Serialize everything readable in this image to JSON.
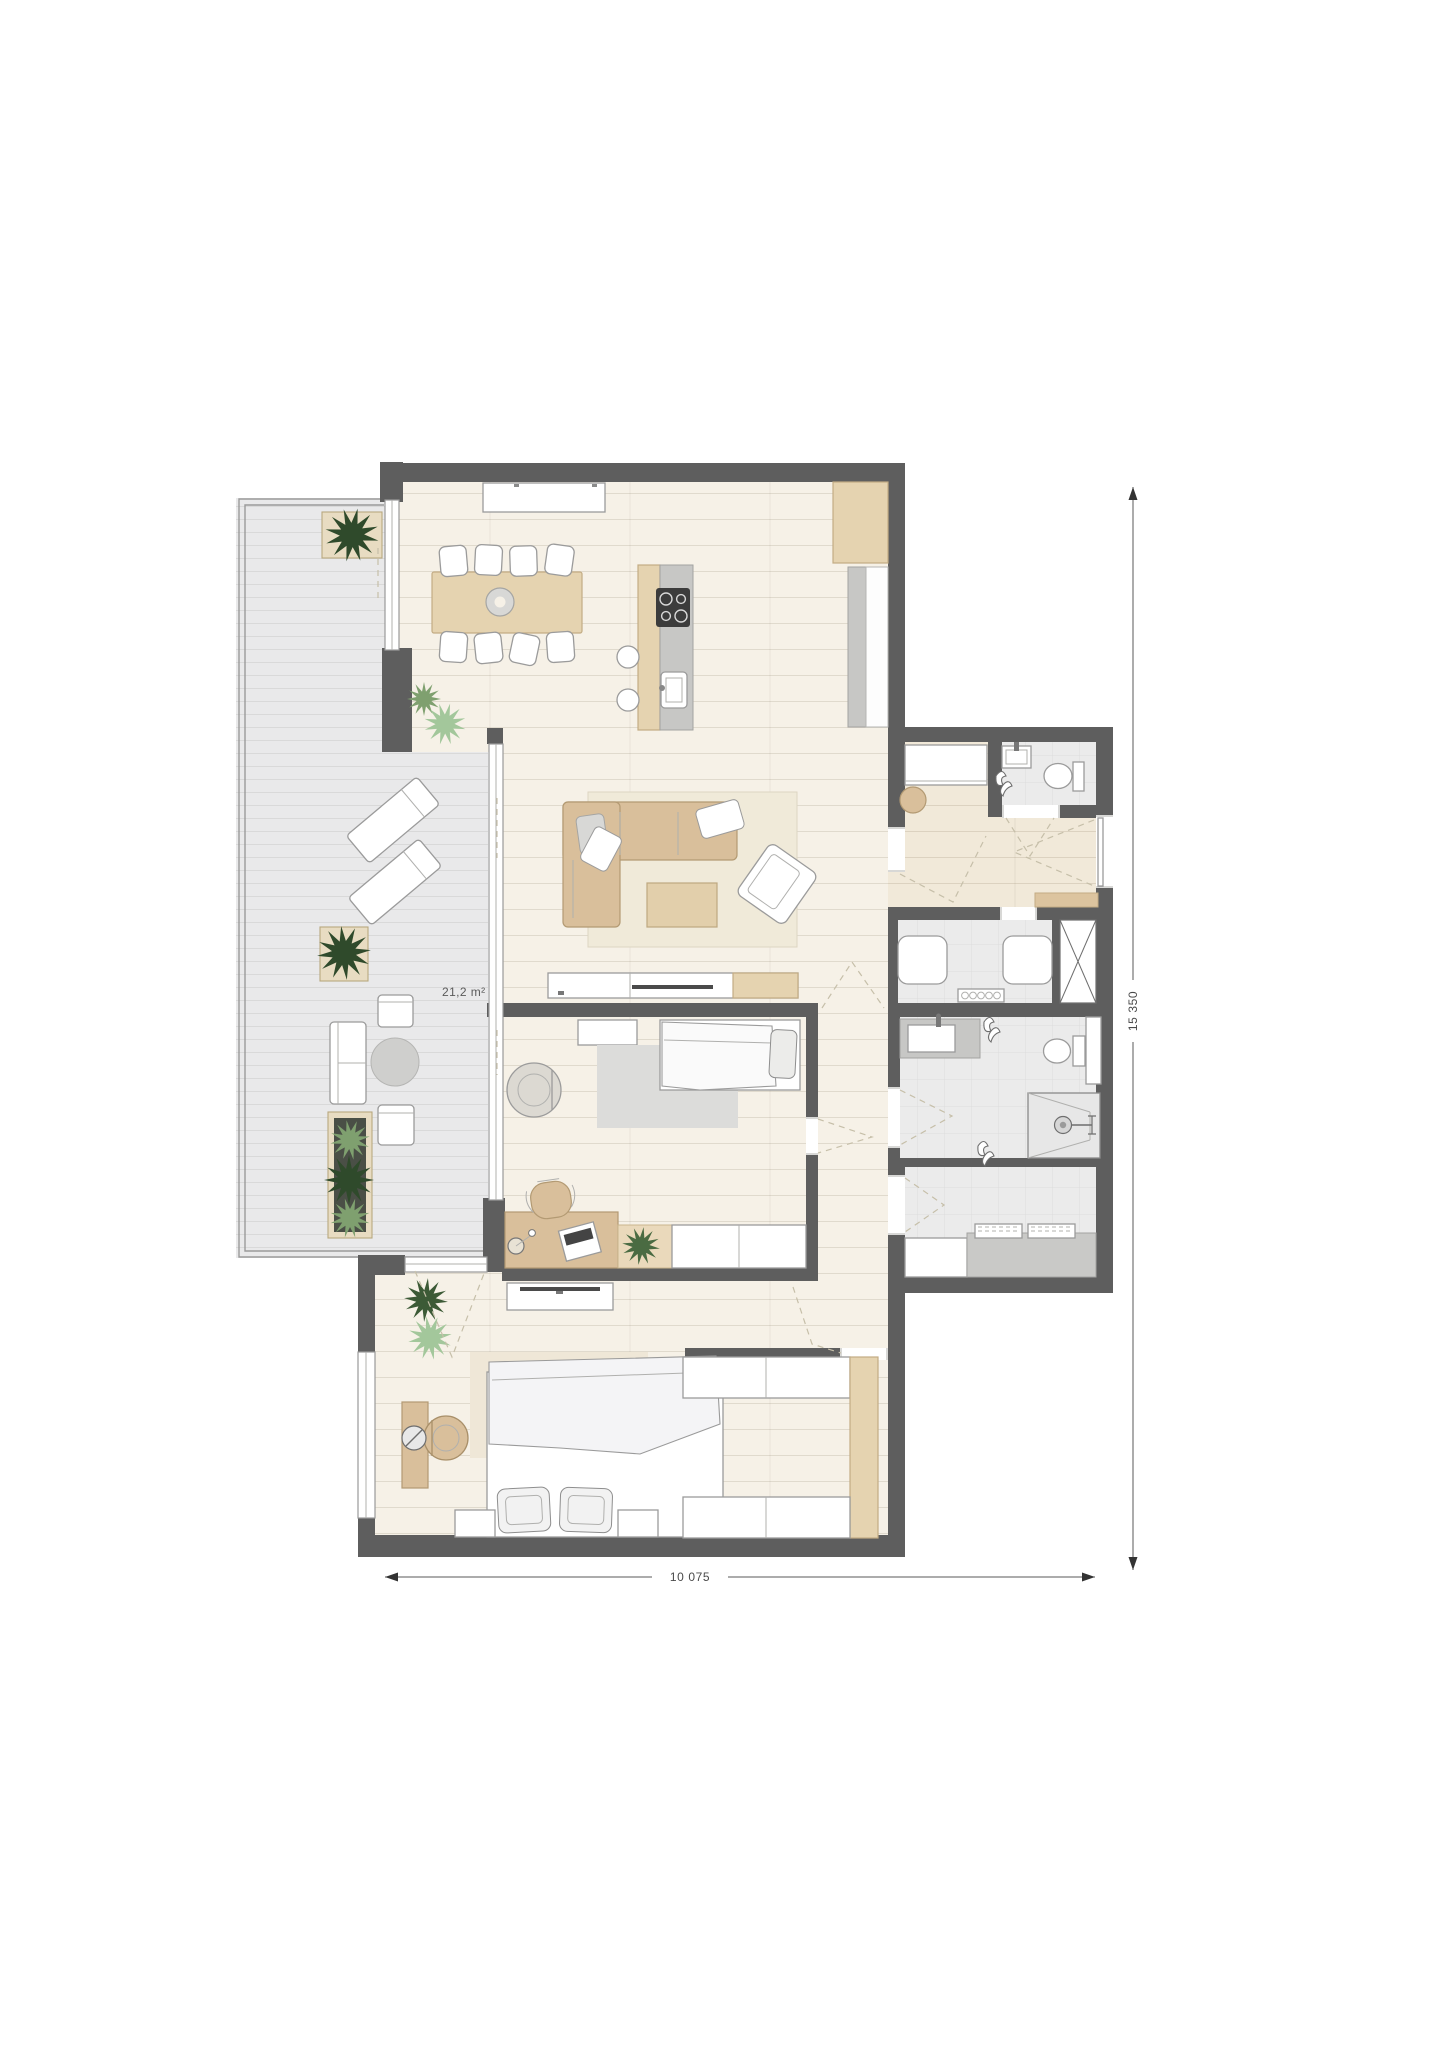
{
  "labels": {
    "balcony_area": "21,2 m²",
    "dim_width": "10 075",
    "dim_height": "15 350"
  },
  "colors": {
    "wall": "#5e5e5e",
    "floor_cream": "#f6f1e7",
    "floor_hall": "#f1e9d9",
    "floor_balcony": "#e9e9ea",
    "floor_tile": "#ebebeb",
    "glass": "#9a9a9a",
    "furn": "#9b9b9b",
    "wood": "#d9bf9b",
    "wood_light": "#e5d3b0",
    "wood_pale": "#ead9bb",
    "counter": "#c7c7c5",
    "rug_beige": "#f0ead9",
    "rug_gray": "#dcdcda",
    "plant_dark": "#2f4a2b",
    "plant_sage": "#7fa06f",
    "plant_light": "#a3c79b",
    "mat": "#dcc49f",
    "dim": "#4a4a4a"
  }
}
